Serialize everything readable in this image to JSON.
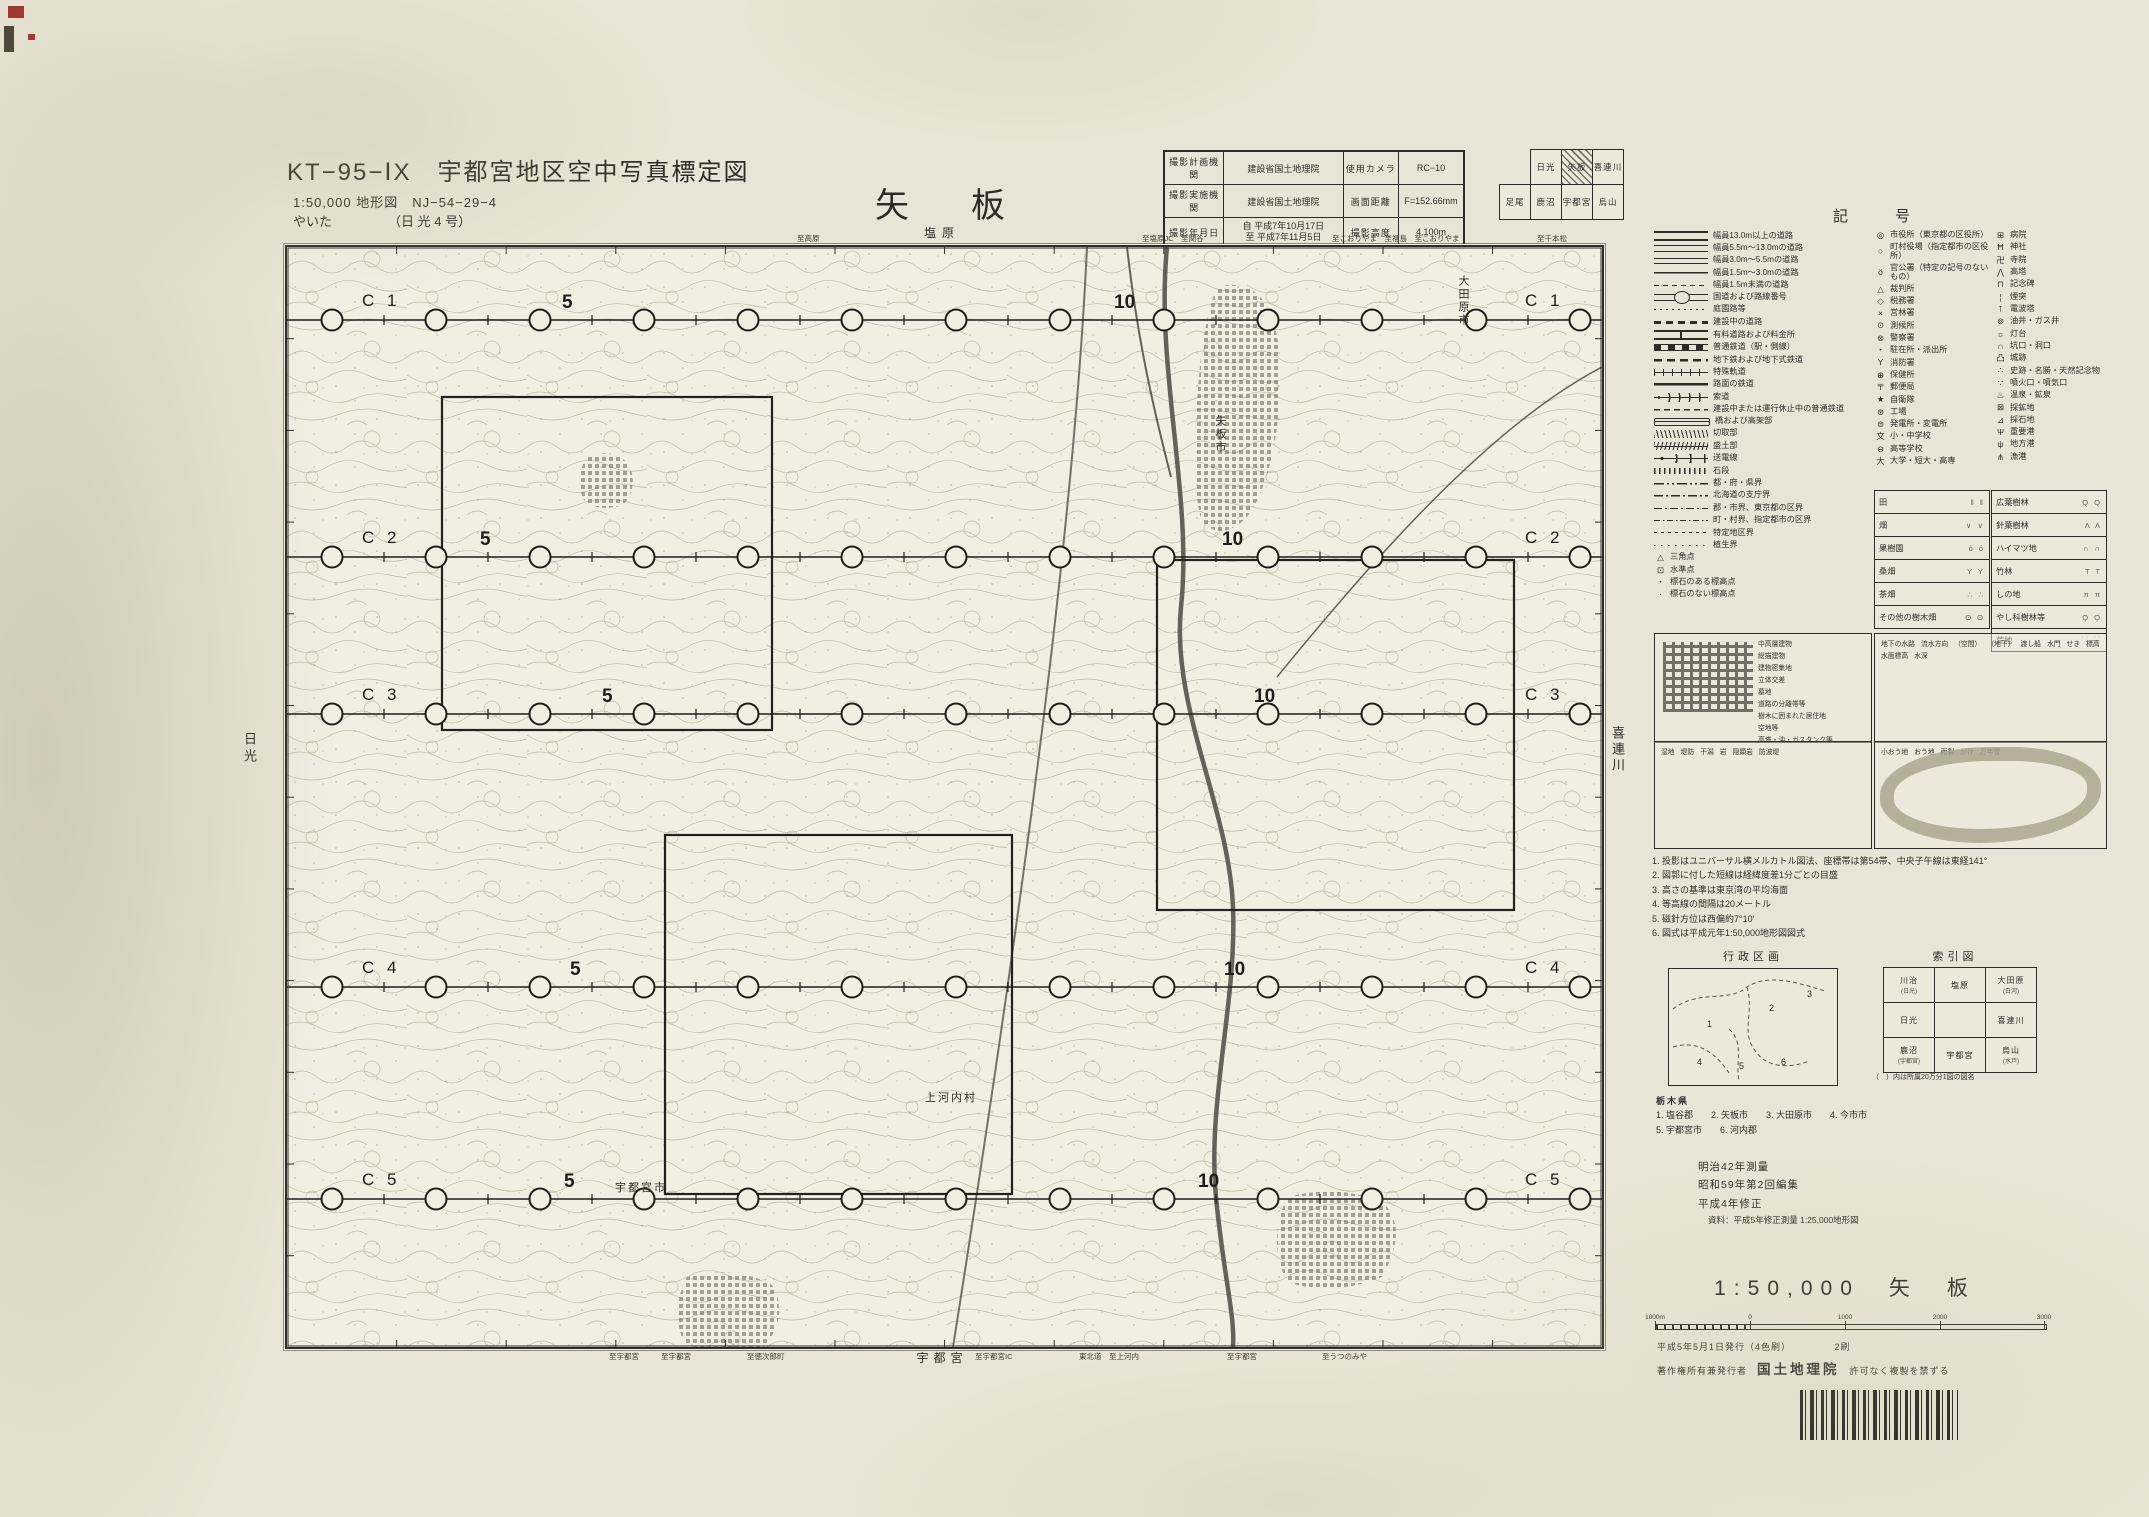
{
  "colors": {
    "paper": "#e9e5d6",
    "map_paper": "#f1eee2",
    "ink": "#2e2c27",
    "contour": "#b8b09a",
    "river": "#4c4942",
    "urban": "#817c6f",
    "reg_red": "#a0342c"
  },
  "header": {
    "series_title": "KT−95−ⅠX　宇都宮地区空中写真標定図",
    "map_spec": "1:50,000 地形図　NJ−54−29−4",
    "map_kana": "やいた",
    "map_kana_note": "（日 光 4 号）",
    "sheet_title": "矢　板"
  },
  "photo_table": {
    "rows": [
      {
        "h1": "撮影計画機関",
        "v1": "建設省国土地理院",
        "h2": "使用カメラ",
        "v2": "RC−10"
      },
      {
        "h1": "撮影実施機関",
        "v1": "建設省国土地理院",
        "h2": "画面距離",
        "v2": "F=152.66mm"
      },
      {
        "h1": "撮影年月日",
        "v1": [
          "自 平成7年10月17日",
          "至 平成7年11月5日"
        ],
        "h2": "撮影高度",
        "v2": "4,100m"
      }
    ]
  },
  "coverage_grid": {
    "rows": [
      [
        null,
        "日光",
        "矢板",
        "喜連川"
      ],
      [
        "足尾",
        "鹿沼",
        "宇都宮",
        "烏山"
      ]
    ],
    "highlight": "矢板"
  },
  "map": {
    "top_label": "塩原",
    "bottom_label": "宇都宮",
    "left_label": "日光",
    "right_label": "喜連川",
    "top_roads": [
      {
        "x": 510,
        "t": "至高原"
      },
      {
        "x": 855,
        "t": "至塩原JC　至関谷"
      },
      {
        "x": 1045,
        "t": "至こおりやま　至福島　至こおりやま"
      },
      {
        "x": 1250,
        "t": "至千本松"
      }
    ],
    "bottom_roads": [
      {
        "x": 322,
        "t": "至宇都宮"
      },
      {
        "x": 374,
        "t": "至宇都宮"
      },
      {
        "x": 460,
        "t": "至徳次郎町"
      },
      {
        "x": 688,
        "t": "至宇都宮IC"
      },
      {
        "x": 792,
        "t": "東北道　至上河内"
      },
      {
        "x": 940,
        "t": "至宇都宮"
      },
      {
        "x": 1035,
        "t": "至うつのみや"
      }
    ],
    "place_labels": [
      {
        "t": "大田原市",
        "x": 1168,
        "y": 28,
        "vertical": true
      },
      {
        "t": "矢板市",
        "x": 925,
        "y": 168,
        "vertical": true
      },
      {
        "t": "上河内村",
        "x": 638,
        "y": 842,
        "vertical": false
      },
      {
        "t": "宇都宮市",
        "x": 328,
        "y": 932,
        "vertical": false
      }
    ],
    "flight_lines": [
      {
        "name": "C 1",
        "y": 73,
        "five_x": 275,
        "ten_x": 827
      },
      {
        "name": "C 2",
        "y": 310,
        "five_x": 193,
        "ten_x": 935
      },
      {
        "name": "C 3",
        "y": 467,
        "five_x": 315,
        "ten_x": 967
      },
      {
        "name": "C 4",
        "y": 740,
        "five_x": 283,
        "ten_x": 937
      },
      {
        "name": "C 5",
        "y": 952,
        "five_x": 277,
        "ten_x": 911
      }
    ],
    "photo_number_five": "5",
    "photo_number_ten": "10",
    "circles": {
      "start_x": 45,
      "step": 104,
      "count": 13
    }
  },
  "legend": {
    "title": "記　号",
    "roads": [
      {
        "sym": "r1",
        "label": "幅員13.0m以上の道路"
      },
      {
        "sym": "r2",
        "label": "幅員5.5m〜13.0mの道路"
      },
      {
        "sym": "r3",
        "label": "幅員3.0m〜5.5mの道路"
      },
      {
        "sym": "r4",
        "label": "幅員1.5m〜3.0mの道路"
      },
      {
        "sym": "r5",
        "label": "幅員1.5m未満の道路"
      },
      {
        "sym": "r6",
        "label": "国道および路線番号"
      },
      {
        "sym": "r7",
        "label": "庭園路等"
      },
      {
        "sym": "r8",
        "label": "建設中の道路"
      },
      {
        "sym": "r9",
        "label": "有料道路および料金所"
      }
    ],
    "railways": [
      {
        "sym": "t1",
        "label": "普通鉄道（駅・側線）"
      },
      {
        "sym": "t2",
        "label": "地下鉄および地下式鉄道"
      },
      {
        "sym": "t3",
        "label": "特殊軌道"
      },
      {
        "sym": "t4",
        "label": "路面の鉄道"
      },
      {
        "sym": "t5",
        "label": "索道"
      },
      {
        "sym": "t6",
        "label": "建設中または運行休止中の普通鉄道"
      },
      {
        "sym": "t7",
        "label": "橋および高架部"
      },
      {
        "sym": "t8",
        "label": "切取部"
      },
      {
        "sym": "t9",
        "label": "盛土部"
      },
      {
        "sym": "t10",
        "label": "送電線"
      },
      {
        "sym": "t11",
        "label": "石段"
      }
    ],
    "boundaries": [
      {
        "sym": "b1",
        "label": "都・府・県界"
      },
      {
        "sym": "b2",
        "label": "北海道の支庁界"
      },
      {
        "sym": "b3",
        "label": "郡・市界、東京都の区界"
      },
      {
        "sym": "b4",
        "label": "町・村界、指定都市の区界"
      },
      {
        "sym": "b5",
        "label": "特定地区界"
      },
      {
        "sym": "b6",
        "label": "植生界"
      }
    ],
    "points": [
      {
        "sym": "△",
        "label": "三角点"
      },
      {
        "sym": "⊡",
        "label": "水準点"
      },
      {
        "sym": "・",
        "label": "標石のある標高点"
      },
      {
        "sym": "·",
        "label": "標石のない標高点"
      }
    ],
    "facilities_a": [
      {
        "sym": "◎",
        "label": "市役所（東京都の区役所）"
      },
      {
        "sym": "○",
        "label": "町村役場（指定都市の区役所）"
      },
      {
        "sym": "ö",
        "label": "官公署（特定の記号のないもの）"
      },
      {
        "sym": "△",
        "label": "裁判所"
      },
      {
        "sym": "◇",
        "label": "税務署"
      },
      {
        "sym": "×",
        "label": "営林署"
      },
      {
        "sym": "⊙",
        "label": "測候所"
      },
      {
        "sym": "⊗",
        "label": "警察署"
      },
      {
        "sym": "・",
        "label": "駐在所・派出所"
      },
      {
        "sym": "Y",
        "label": "消防署"
      },
      {
        "sym": "⊕",
        "label": "保健所"
      },
      {
        "sym": "〒",
        "label": "郵便局"
      },
      {
        "sym": "★",
        "label": "自衛隊"
      },
      {
        "sym": "⊛",
        "label": "工場"
      },
      {
        "sym": "⊜",
        "label": "発電所・変電所"
      },
      {
        "sym": "文",
        "label": "小・中学校"
      },
      {
        "sym": "⊖",
        "label": "高等学校"
      },
      {
        "sym": "大",
        "label": "大学・短大・高専"
      }
    ],
    "facilities_b": [
      {
        "sym": "⊞",
        "label": "病院"
      },
      {
        "sym": "Ħ",
        "label": "神社"
      },
      {
        "sym": "卍",
        "label": "寺院"
      },
      {
        "sym": "⋀",
        "label": "高塔"
      },
      {
        "sym": "⊓",
        "label": "記念碑"
      },
      {
        "sym": "¦",
        "label": "煙突"
      },
      {
        "sym": "⊺",
        "label": "電波塔"
      },
      {
        "sym": "⊚",
        "label": "油井・ガス井"
      },
      {
        "sym": "☼",
        "label": "灯台"
      },
      {
        "sym": "∩",
        "label": "坑口・洞口"
      },
      {
        "sym": "凸",
        "label": "城跡"
      },
      {
        "sym": "∴",
        "label": "史跡・名勝・天然記念物"
      },
      {
        "sym": "∵",
        "label": "噴火口・噴気口"
      },
      {
        "sym": "♨",
        "label": "温泉・鉱泉"
      },
      {
        "sym": "⊠",
        "label": "採鉱地"
      },
      {
        "sym": "⊿",
        "label": "採石地"
      },
      {
        "sym": "Ψ",
        "label": "重要港"
      },
      {
        "sym": "ψ",
        "label": "地方港"
      },
      {
        "sym": "⋔",
        "label": "漁港"
      }
    ],
    "landuse_left": [
      {
        "label": "田",
        "glyph": "‖ ‖"
      },
      {
        "label": "畑",
        "glyph": "∨ ∨"
      },
      {
        "label": "果樹園",
        "glyph": "ό ό"
      },
      {
        "label": "桑畑",
        "glyph": "Y Y"
      },
      {
        "label": "茶畑",
        "glyph": "∴ ∴"
      },
      {
        "label": "その他の樹木畑",
        "glyph": "ʘ ʘ"
      }
    ],
    "landuse_right": [
      {
        "label": "広葉樹林",
        "glyph": "Q Q"
      },
      {
        "label": "針葉樹林",
        "glyph": "Λ Λ"
      },
      {
        "label": "ハイマツ地",
        "glyph": "∩ ∩"
      },
      {
        "label": "竹林",
        "glyph": "T T"
      },
      {
        "label": "しの地",
        "glyph": "π π"
      },
      {
        "label": "やし科樹林等",
        "glyph": "Ϙ Ϙ"
      },
      {
        "label": "荒地",
        "glyph": "⸪ ⸪"
      }
    ],
    "example_boxes": [
      {
        "id": "ex-urban",
        "labels": [
          "中高層建物",
          "総描建物",
          "建物密集地",
          "立体交差",
          "墓地",
          "道路の分離帯等",
          "樹木に囲まれた居住地",
          "空地等",
          "高塔・油・ガスタンク等"
        ]
      },
      {
        "id": "ex-water",
        "labels": [
          "地下の水路",
          "流水方向",
          "（空間）",
          "（地下）",
          "渡し船",
          "水門",
          "せき",
          "標高",
          "水面標高",
          "水深"
        ]
      },
      {
        "id": "ex-coast",
        "labels": [
          "湿地",
          "堤防",
          "干潟",
          "岩",
          "隠顕岩",
          "防波堤"
        ]
      },
      {
        "id": "ex-contour",
        "labels": [
          "小おう地",
          "おう地",
          "雨裂",
          "がけ",
          "万年雪"
        ]
      }
    ]
  },
  "notes": [
    "1. 投影はユニバーサル横メルカトル図法、座標帯は第54帯、中央子午線は東経141°",
    "2. 図郭に付した短線は経緯度差1分ごとの目盛",
    "3. 高さの基準は東京湾の平均海面",
    "4. 等高線の間隔は20メートル",
    "5. 磁針方位は西偏約7°10′",
    "6. 図式は平成元年1:50,000地形図図式"
  ],
  "admin": {
    "title": "行政区画",
    "pref": "栃木県",
    "items": [
      "1. 塩谷郡",
      "2. 矢板市",
      "3. 大田原市",
      "4. 今市市",
      "5. 宇都宮市",
      "6. 河内郡"
    ],
    "map_numbers": [
      {
        "n": "1",
        "x": 38,
        "y": 58
      },
      {
        "n": "2",
        "x": 100,
        "y": 42
      },
      {
        "n": "3",
        "x": 138,
        "y": 28
      },
      {
        "n": "4",
        "x": 28,
        "y": 96
      },
      {
        "n": "5",
        "x": 70,
        "y": 100
      },
      {
        "n": "6",
        "x": 112,
        "y": 96
      }
    ]
  },
  "index_map": {
    "title": "索引図",
    "rows": [
      [
        "川治",
        "塩原",
        "大田原"
      ],
      [
        "日光",
        "",
        "喜連川"
      ],
      [
        "鹿沼",
        "宇都宮",
        "烏山"
      ]
    ],
    "sub_rows": [
      [
        "(日光)",
        "",
        "(白河)"
      ],
      [
        "",
        "",
        ""
      ],
      [
        "(宇都宮)",
        "",
        "(水戸)"
      ]
    ],
    "highlight_row": 1,
    "highlight_col": 1,
    "note": "（　）内は所属20万分1図の図名"
  },
  "imprint": {
    "lines": [
      "明治42年測量",
      "昭和59年第2回編集",
      "平成4年修正"
    ],
    "source": "資料：平成5年修正測量 1:25,000地形図",
    "scale_title": "1:50,000　矢　板",
    "scale_labels": [
      "1000m",
      "0",
      "1000",
      "2000",
      "3000"
    ]
  },
  "publisher": {
    "line1": "平成5年5月1日発行（4色刷）",
    "edition": "2刷",
    "line2_left": "著作権所有兼発行者",
    "agency": "国土地理院",
    "line2_right": "許可なく複製を禁ずる"
  }
}
